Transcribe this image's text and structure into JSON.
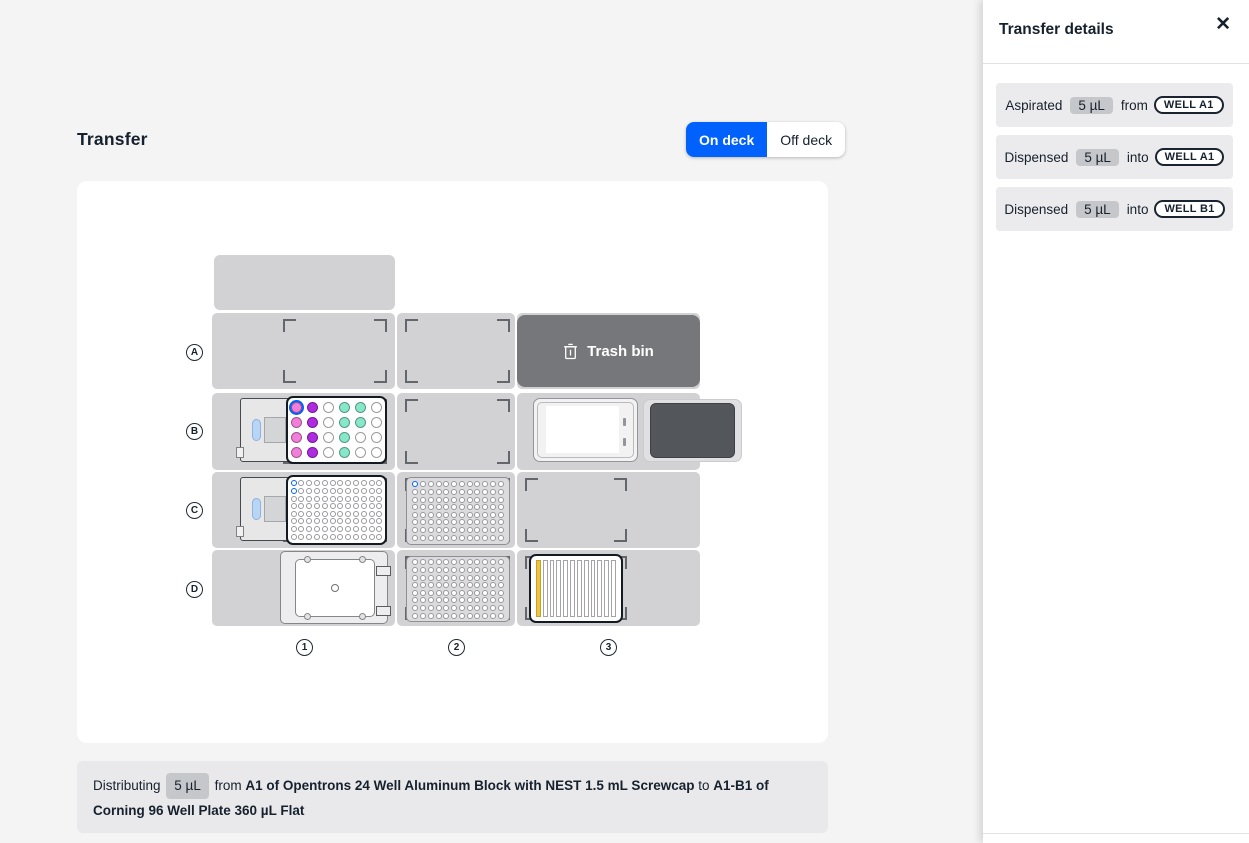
{
  "header": {
    "title": "Transfer",
    "toggle_on": "On deck",
    "toggle_off": "Off deck"
  },
  "sidebar": {
    "title": "Transfer details",
    "events": [
      {
        "action": "Aspirated",
        "volume": "5 µL",
        "preposition": "from",
        "well": "WELL A1"
      },
      {
        "action": "Dispensed",
        "volume": "5 µL",
        "preposition": "into",
        "well": "WELL A1"
      },
      {
        "action": "Dispensed",
        "volume": "5 µL",
        "preposition": "into",
        "well": "WELL B1"
      }
    ]
  },
  "deck": {
    "row_labels": [
      "A",
      "B",
      "C",
      "D"
    ],
    "column_labels": [
      "1",
      "2",
      "3"
    ],
    "trash_label": "Trash bin",
    "labware": {
      "aluminum_block": {
        "well_colors": [
          [
            "pink",
            "purple",
            "",
            "teal",
            "teal",
            ""
          ],
          [
            "pink",
            "purple",
            "",
            "teal",
            "teal",
            ""
          ],
          [
            "pink",
            "purple",
            "",
            "teal",
            "",
            ""
          ],
          [
            "pink",
            "purple",
            "",
            "teal",
            "",
            ""
          ]
        ],
        "selected_cell": {
          "row": 0,
          "col": 0
        }
      },
      "plate_c1": {
        "rows": 8,
        "cols": 12,
        "highlighted_wells": [
          "A1",
          "B1"
        ]
      },
      "plate_c2": {
        "rows": 8,
        "cols": 12,
        "highlighted_wells": [
          "A1"
        ]
      },
      "plate_d2": {
        "rows": 8,
        "cols": 12,
        "highlighted_wells": []
      },
      "tiprack": {
        "columns": 12,
        "highlighted_columns": [
          1
        ]
      }
    }
  },
  "footer": {
    "action": "Distributing",
    "volume": "5 µL",
    "from_word": "from",
    "source": "A1 of Opentrons 24 Well Aluminum Block with NEST 1.5 mL Screwcap",
    "to_word": "to",
    "destination": "A1-B1 of Corning 96 Well Plate 360 µL Flat"
  },
  "icons": {
    "close": "✕"
  },
  "colors": {
    "accent_blue": "#0061FD",
    "well_pink": "#F27EDA",
    "well_purple": "#AF2BE1",
    "well_teal": "#86E8C8",
    "tip_yellow": "#EFC53E",
    "trash_gray": "#76777A"
  }
}
